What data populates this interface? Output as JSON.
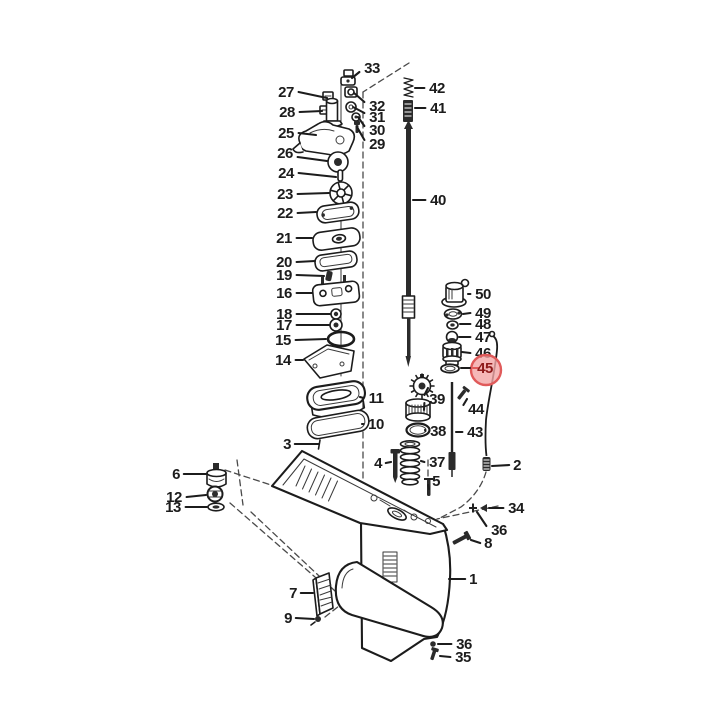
{
  "figure": {
    "type": "exploded-parts-diagram",
    "subject": "outboard-gearcase-lower-unit",
    "total_labeled_parts": 50,
    "colors": {
      "ink": "#1c1c1c",
      "background": "#ffffff",
      "leader": "#1c1c1c",
      "highlight_fill": "#f2a6a6",
      "highlight_ring": "#e05a5a",
      "highlight_text": "#8e1b1b"
    },
    "highlighted_part": {
      "number": "45",
      "cx": 486,
      "cy": 370,
      "r": 15
    },
    "callouts": [
      {
        "n": "27",
        "lx": 286,
        "ly": 92,
        "tx": 327,
        "ty": 98
      },
      {
        "n": "28",
        "lx": 287,
        "ly": 112,
        "tx": 322,
        "ty": 111
      },
      {
        "n": "25",
        "lx": 286,
        "ly": 133,
        "tx": 316,
        "ty": 135
      },
      {
        "n": "26",
        "lx": 285,
        "ly": 153,
        "tx": 327,
        "ty": 161
      },
      {
        "n": "24",
        "lx": 286,
        "ly": 173,
        "tx": 336,
        "ty": 177
      },
      {
        "n": "23",
        "lx": 285,
        "ly": 194,
        "tx": 329,
        "ty": 193
      },
      {
        "n": "22",
        "lx": 285,
        "ly": 213,
        "tx": 316,
        "ty": 212
      },
      {
        "n": "21",
        "lx": 284,
        "ly": 238,
        "tx": 312,
        "ty": 238
      },
      {
        "n": "20",
        "lx": 284,
        "ly": 262,
        "tx": 315,
        "ty": 261
      },
      {
        "n": "19",
        "lx": 284,
        "ly": 275,
        "tx": 324,
        "ty": 276
      },
      {
        "n": "16",
        "lx": 284,
        "ly": 293,
        "tx": 312,
        "ty": 293
      },
      {
        "n": "18",
        "lx": 284,
        "ly": 314,
        "tx": 330,
        "ty": 314
      },
      {
        "n": "17",
        "lx": 284,
        "ly": 325,
        "tx": 329,
        "ty": 325
      },
      {
        "n": "15",
        "lx": 283,
        "ly": 340,
        "tx": 326,
        "ty": 339
      },
      {
        "n": "14",
        "lx": 283,
        "ly": 360,
        "tx": 303,
        "ty": 360
      },
      {
        "n": "3",
        "lx": 287,
        "ly": 444,
        "tx": 319,
        "ty": 444
      },
      {
        "n": "6",
        "lx": 176,
        "ly": 474,
        "tx": 206,
        "ty": 474
      },
      {
        "n": "12",
        "lx": 174,
        "ly": 497,
        "tx": 206,
        "ty": 495
      },
      {
        "n": "13",
        "lx": 173,
        "ly": 507,
        "tx": 207,
        "ty": 507
      },
      {
        "n": "7",
        "lx": 293,
        "ly": 593,
        "tx": 313,
        "ty": 593
      },
      {
        "n": "9",
        "lx": 288,
        "ly": 618,
        "tx": 314,
        "ty": 619
      },
      {
        "n": "33",
        "lx": 372,
        "ly": 68,
        "tx": 352,
        "ty": 78
      },
      {
        "n": "32",
        "lx": 377,
        "ly": 106,
        "tx": 354,
        "ty": 93
      },
      {
        "n": "31",
        "lx": 377,
        "ly": 117,
        "tx": 353,
        "ty": 107
      },
      {
        "n": "30",
        "lx": 377,
        "ly": 130,
        "tx": 358,
        "ty": 117
      },
      {
        "n": "29",
        "lx": 377,
        "ly": 144,
        "tx": 357,
        "ty": 127
      },
      {
        "n": "42",
        "lx": 437,
        "ly": 88,
        "tx": 415,
        "ty": 88
      },
      {
        "n": "41",
        "lx": 438,
        "ly": 108,
        "tx": 415,
        "ty": 108
      },
      {
        "n": "40",
        "lx": 438,
        "ly": 200,
        "tx": 413,
        "ty": 200
      },
      {
        "n": "50",
        "lx": 483,
        "ly": 294,
        "tx": 468,
        "ty": 294
      },
      {
        "n": "49",
        "lx": 483,
        "ly": 313,
        "tx": 463,
        "ty": 314
      },
      {
        "n": "48",
        "lx": 483,
        "ly": 324,
        "tx": 460,
        "ty": 324
      },
      {
        "n": "47",
        "lx": 483,
        "ly": 337,
        "tx": 459,
        "ty": 337
      },
      {
        "n": "46",
        "lx": 483,
        "ly": 353,
        "tx": 462,
        "ty": 352
      },
      {
        "n": "45",
        "lx": 485,
        "ly": 368,
        "tx": 461,
        "ty": 368
      },
      {
        "n": "11",
        "lx": 376,
        "ly": 398,
        "tx": 360,
        "ty": 397
      },
      {
        "n": "39",
        "lx": 437,
        "ly": 399,
        "tx": 428,
        "ty": 388,
        "t2x": 424,
        "t2y": 410
      },
      {
        "n": "10",
        "lx": 376,
        "ly": 424,
        "tx": 362,
        "ty": 424
      },
      {
        "n": "38",
        "lx": 438,
        "ly": 431,
        "tx": 425,
        "ty": 430
      },
      {
        "n": "44",
        "lx": 476,
        "ly": 409,
        "tx": 467,
        "ty": 399
      },
      {
        "n": "43",
        "lx": 475,
        "ly": 432,
        "tx": 456,
        "ty": 432
      },
      {
        "n": "37",
        "lx": 437,
        "ly": 462,
        "tx": 421,
        "ty": 461
      },
      {
        "n": "4",
        "lx": 378,
        "ly": 463,
        "tx": 391,
        "ty": 462
      },
      {
        "n": "5",
        "lx": 436,
        "ly": 481,
        "tx": 429,
        "ty": 489
      },
      {
        "n": "2",
        "lx": 517,
        "ly": 465,
        "tx": 492,
        "ty": 466
      },
      {
        "n": "34",
        "lx": 516,
        "ly": 508,
        "tx": 489,
        "ty": 508
      },
      {
        "n": "36",
        "lx": 499,
        "ly": 530,
        "tx": 477,
        "ty": 512
      },
      {
        "n": "8",
        "lx": 488,
        "ly": 543,
        "tx": 471,
        "ty": 540
      },
      {
        "n": "1",
        "lx": 473,
        "ly": 579,
        "tx": 449,
        "ty": 579
      },
      {
        "n": "36",
        "lx": 464,
        "ly": 644,
        "tx": 438,
        "ty": 644
      },
      {
        "n": "35",
        "lx": 463,
        "ly": 657,
        "tx": 440,
        "ty": 656
      }
    ]
  }
}
